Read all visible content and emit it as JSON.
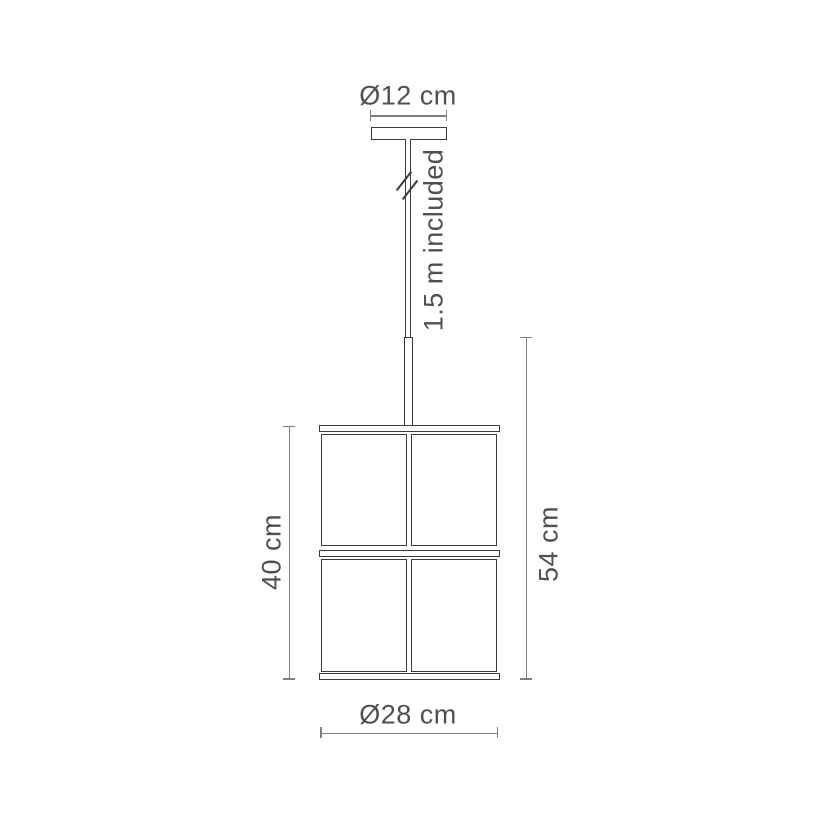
{
  "diagram": {
    "labels": {
      "canopy_diameter": "Ø12 cm",
      "cable_length": "1.5 m included",
      "shade_height": "40 cm",
      "overall_height": "54 cm",
      "shade_diameter": "Ø28 cm"
    },
    "colors": {
      "outline": "#3a3b3d",
      "dimension_line": "#7d7f82",
      "text": "#4f5052",
      "background": "#ffffff"
    }
  }
}
